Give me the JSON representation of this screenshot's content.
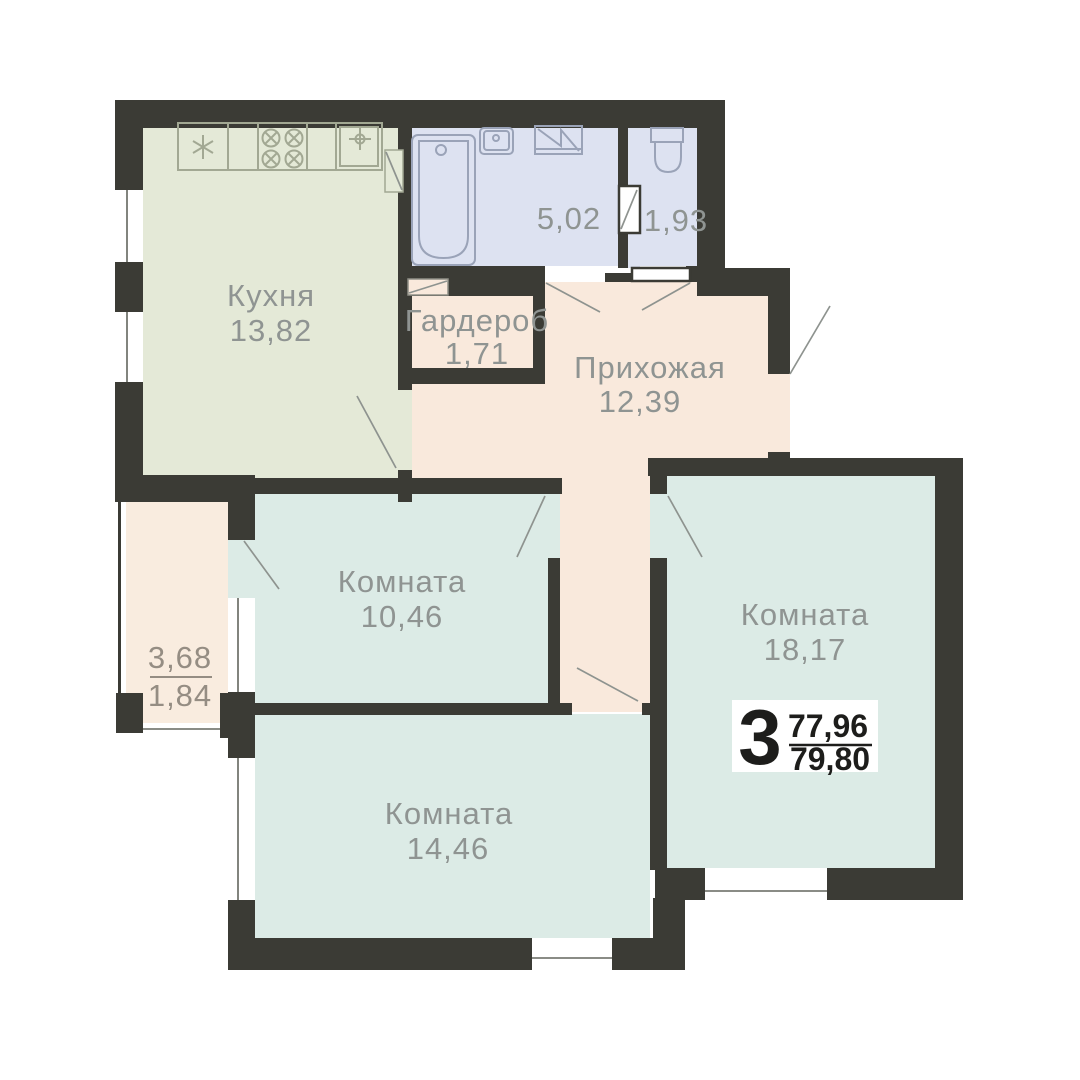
{
  "plan": {
    "kitchen": {
      "label": "Кухня",
      "area": "13,82"
    },
    "bathroom": {
      "area": "5,02"
    },
    "wc": {
      "area": "1,93"
    },
    "wardrobe": {
      "label": "Гардероб",
      "area": "1,71"
    },
    "hallway": {
      "label": "Прихожая",
      "area": "12,39"
    },
    "room_10": {
      "label": "Комната",
      "area": "10,46"
    },
    "room_18": {
      "label": "Комната",
      "area": "18,17"
    },
    "room_14": {
      "label": "Комната",
      "area": "14,46"
    },
    "balcony": {
      "area": "3,68",
      "area_reduced": "1,84"
    }
  },
  "badge": {
    "rooms_count": "3",
    "area_upper": "77,96",
    "area_lower": "79,80"
  },
  "colors": {
    "wall": "#3b3b35",
    "kitchen_fill": "#e4e9d7",
    "wet_fill": "#dde2f1",
    "hall_fill": "#f9e9dc",
    "room_fill": "#dcebe6",
    "label_text": "#8f9492",
    "badge_text": "#1d1d1b"
  }
}
